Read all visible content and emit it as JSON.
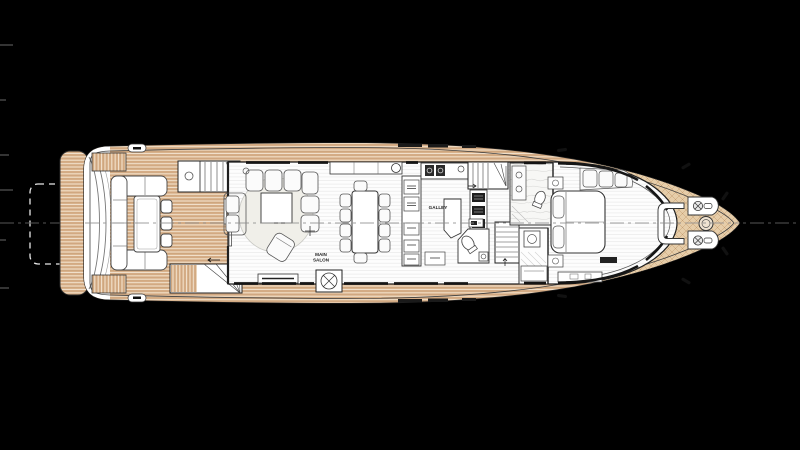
{
  "labels": {
    "main_salon_line1": "MAIN",
    "main_salon_line2": "SALON",
    "galley": "GALLEY"
  },
  "colors": {
    "background": "#000000",
    "hull_fill": "#ffffff",
    "outline": "#222222",
    "teak": "#d9b28c",
    "teak_line": "#bb9066",
    "bow_teak": "#e6cda9",
    "interior_floor_line": "#e6e6e6",
    "centerline": "#8f8f8f",
    "platform_dash_outline": "#e8e8e8",
    "window": "#141414"
  }
}
